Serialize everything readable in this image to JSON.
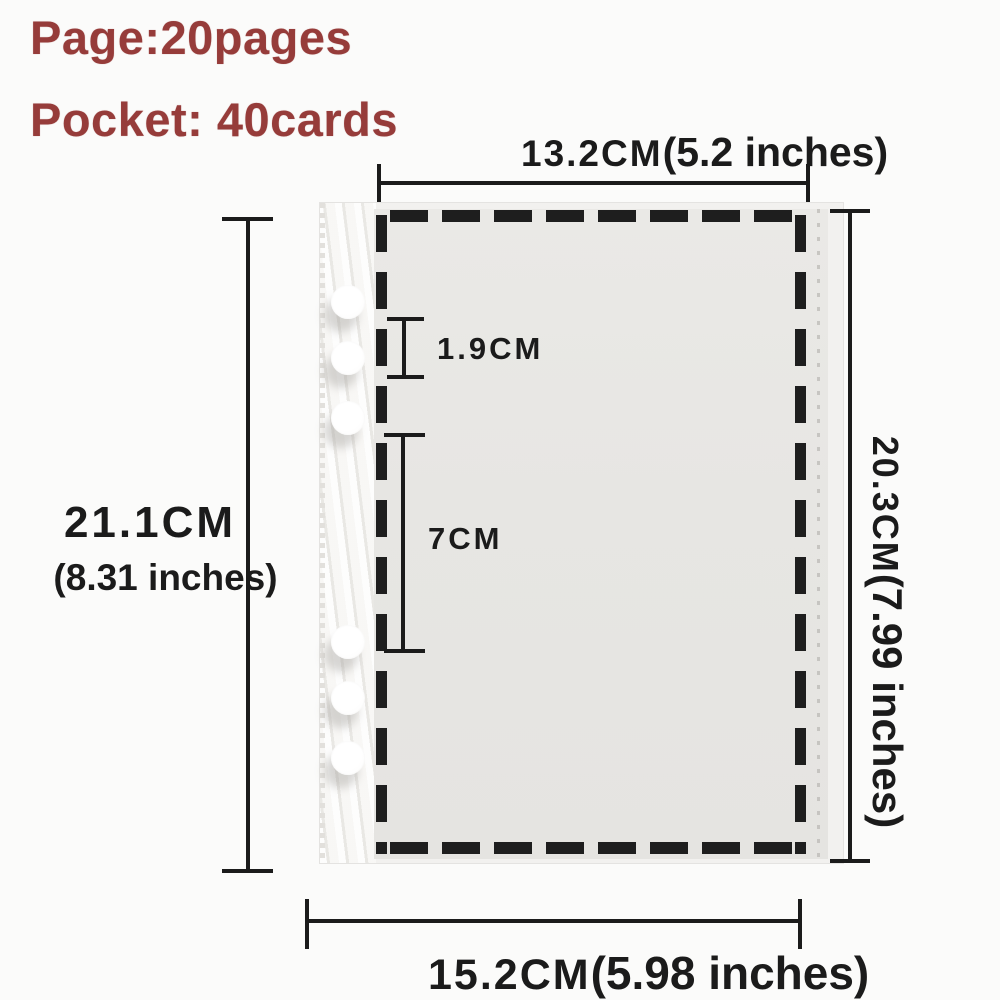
{
  "title": {
    "pages_line": "Page:20pages",
    "pockets_line": "Pocket: 40cards"
  },
  "measurements": {
    "top_width": {
      "cm": "13.2CM",
      "inches": "(5.2 inches)"
    },
    "left_height": {
      "cm": "21.1CM",
      "inches": "(8.31 inches)"
    },
    "right_height": {
      "cm": "20.3CM",
      "inches": "(7.99 inches)"
    },
    "bottom_width": {
      "cm": "15.2CM",
      "inches": "(5.98 inches)"
    },
    "pocket_top_gap": "1.9CM",
    "pocket_section_height": "7CM"
  },
  "diagram": {
    "hole_count": 6,
    "colors": {
      "title_red": "#963c3a",
      "line_black": "#1b1b1b",
      "dash_black": "#1e1e1e",
      "pocket_gray": "#e7e6e3",
      "sleeve_white": "#f2f1ef"
    }
  }
}
